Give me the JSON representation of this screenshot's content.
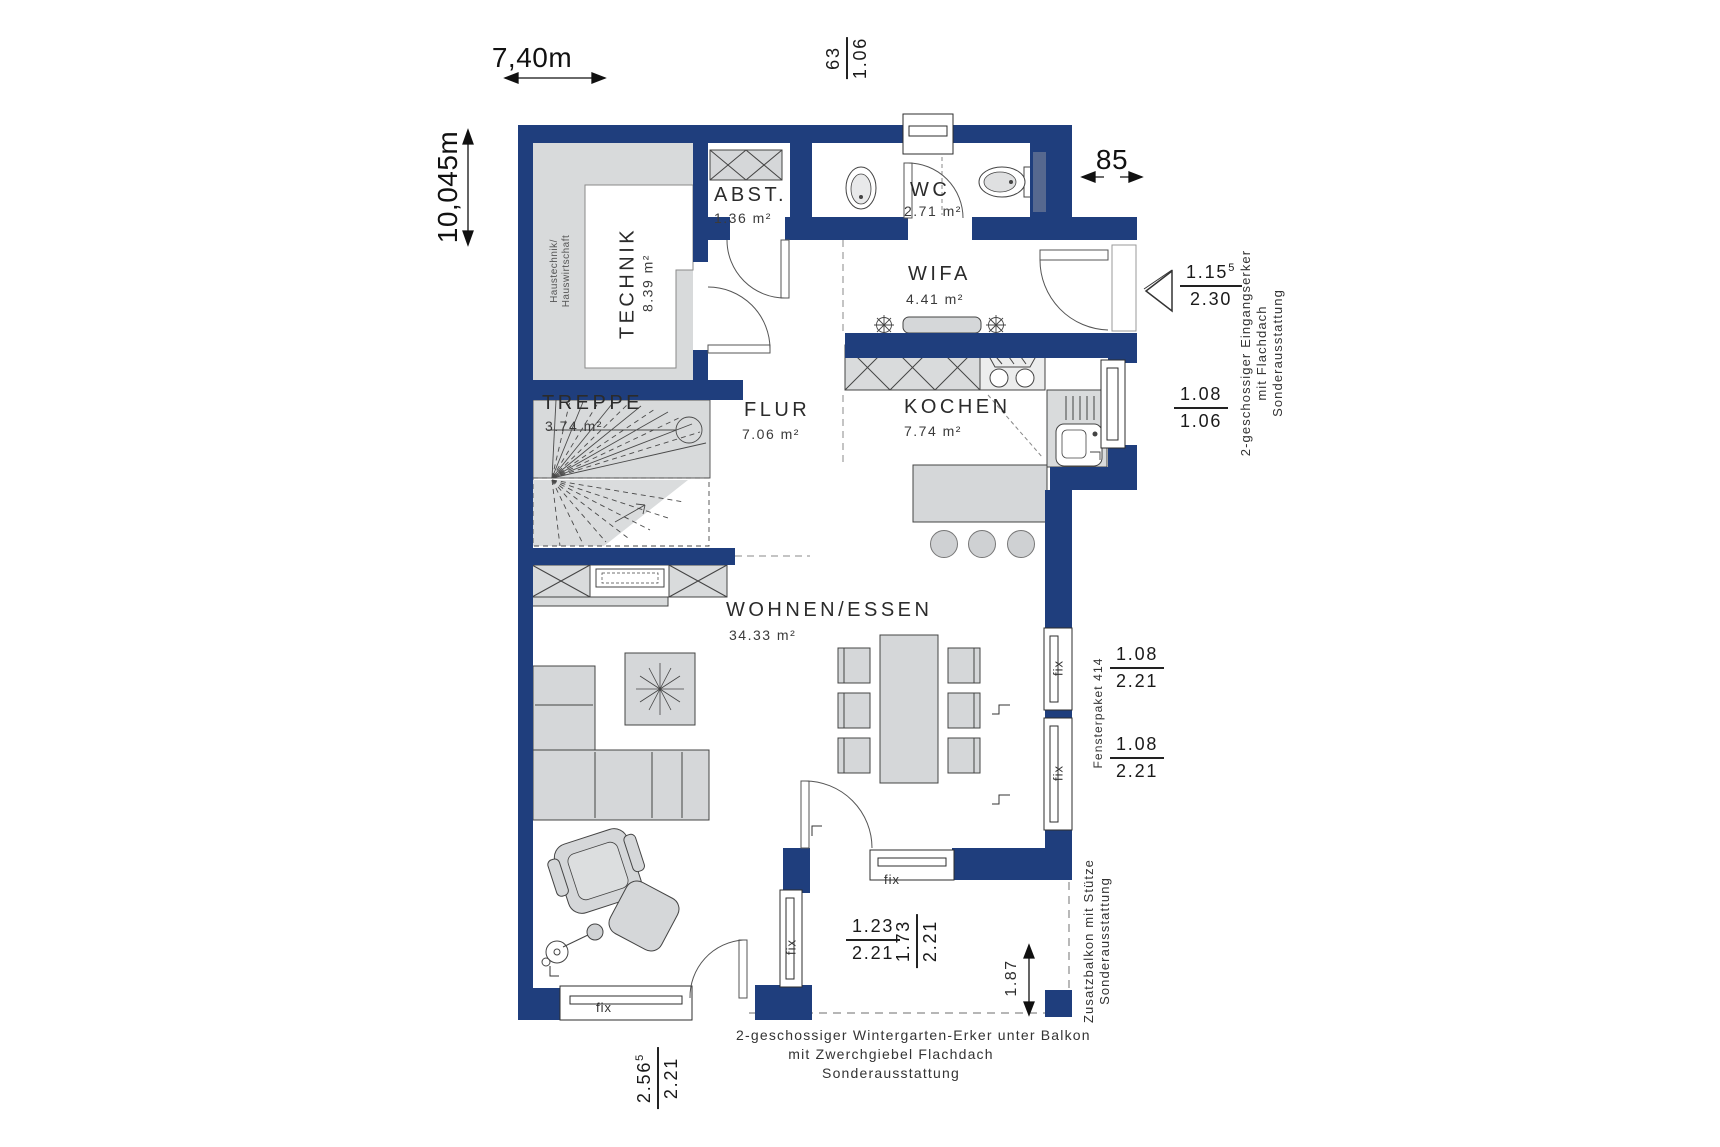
{
  "rooms": [
    {
      "name": "TECHNIK",
      "area": "8.39 m²"
    },
    {
      "name": "ABST.",
      "area": "1.36 m²"
    },
    {
      "name": "WC",
      "area": "2.71 m²"
    },
    {
      "name": "WIFA",
      "area": "4.41 m²"
    },
    {
      "name": "FLUR",
      "area": "7.06 m²"
    },
    {
      "name": "KOCHEN",
      "area": "7.74 m²"
    },
    {
      "name": "TREPPE",
      "area": "3.74 m²"
    },
    {
      "name": "WOHNEN/ESSEN",
      "area": "34.33 m²"
    }
  ],
  "dims": {
    "width_total": "7,40m",
    "height_total": "10,045m",
    "entry_niche": "85",
    "balcony_depth": "1.87"
  },
  "fracs": {
    "top_window": {
      "num": "63",
      "den": "1.06"
    },
    "entry_door": {
      "num": "1.15",
      "sup": "5",
      "den": "2.30"
    },
    "kitchen_window": {
      "num": "1.08",
      "den": "1.06"
    },
    "right_window_upper": {
      "num": "1.08",
      "den": "2.21"
    },
    "right_window_lower": {
      "num": "1.08",
      "den": "2.21"
    },
    "wintergarten_side": {
      "num": "1.23",
      "den": "2.21"
    },
    "wintergarten_front": {
      "num": "1.73",
      "den": "2.21"
    },
    "south_window": {
      "num": "2.56",
      "sup": "5",
      "den": "2.21"
    }
  },
  "notes": {
    "haustechnik_l1": "Haustechnik/",
    "haustechnik_l2": "Hauswirtschaft",
    "eingang_l1": "2-geschossiger Eingangserker",
    "eingang_l2": "mit Flachdach",
    "eingang_l3": "Sonderausstattung",
    "fensterpaket": "Fensterpaket 414",
    "balkon_l1": "Zusatzbalkon mit Stütze",
    "balkon_l2": "Sonderausstattung",
    "wintergarten_l1": "2-geschossiger Wintergarten-Erker unter Balkon",
    "wintergarten_l2": "mit Zwerchgiebel Flachdach",
    "wintergarten_l3": "Sonderausstattung",
    "fix": "fix"
  },
  "colors": {
    "wall": "#1f3e7d",
    "floor_gray": "#d8dadb",
    "furniture": "#d5d7d9"
  }
}
